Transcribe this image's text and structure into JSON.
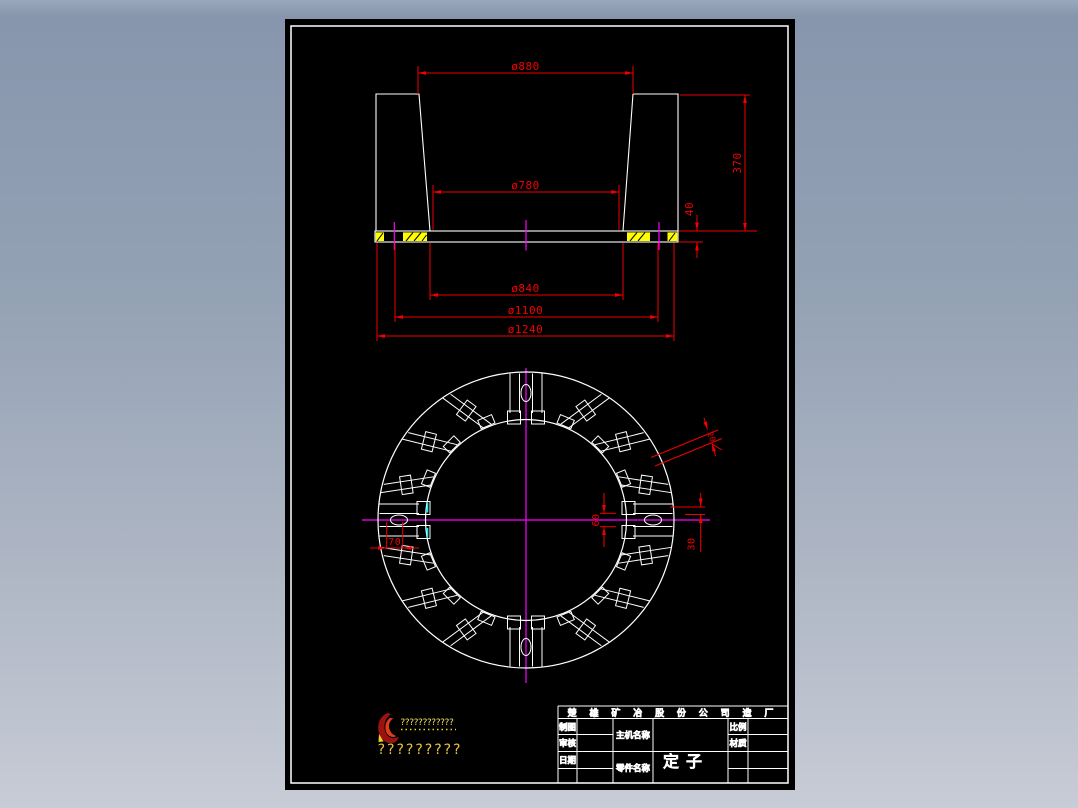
{
  "colors": {
    "background_top": "#8796ad",
    "background_bottom": "#c7ccd6",
    "canvas": "#000000",
    "geometry_line": "#ffffff",
    "dimension": "#f20000",
    "centerline": "#ff00ff",
    "hatch_fill": "#ffff00",
    "snap_marker": "#00ffff",
    "logo_text": "#edc63c"
  },
  "section_view": {
    "dims": {
      "top_diameter": "ø880",
      "bore_diameter": "ø780",
      "step_diameter": "ø840",
      "bolt_circle_diameter": "ø1100",
      "outer_diameter": "ø1240",
      "height": "370",
      "flange_thickness": "40"
    }
  },
  "plan_view": {
    "dims": {
      "slot_offset": "70",
      "slot_width": "60",
      "slot_half_width": "30",
      "duct_width": "20"
    }
  },
  "logo": {
    "line1": "????????????",
    "line2": "?????????"
  },
  "title_block": {
    "company": "楚 雄 矿 冶 股 份 公 司 造 厂",
    "labels": {
      "drafter": "制图",
      "checker": "审核",
      "date": "日期",
      "machine_name": "主机名称",
      "part_name": "零件名称",
      "scale": "比例",
      "material": "材质"
    },
    "values": {
      "part_name": "定子"
    }
  }
}
